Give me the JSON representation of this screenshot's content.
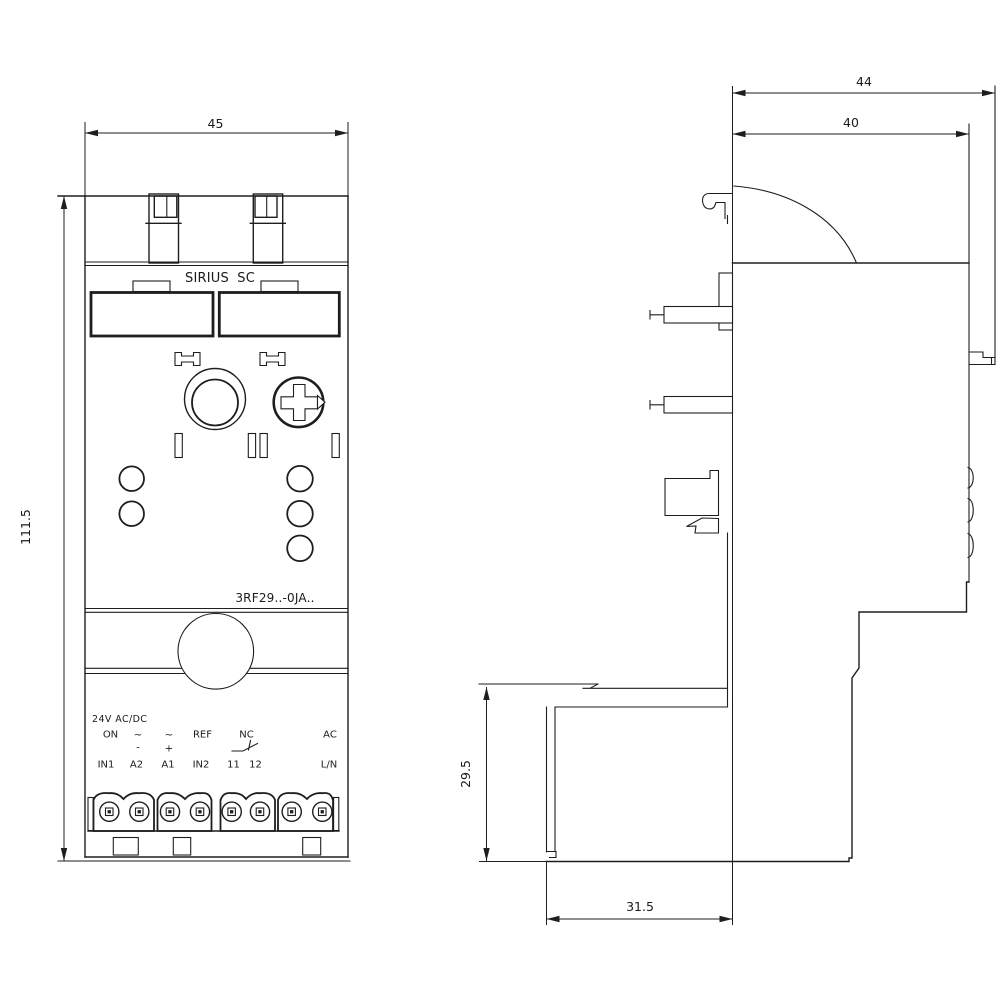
{
  "front_view": {
    "width_dim": "45",
    "height_dim": "111.5",
    "brand_label": "SIRIUS SC",
    "type_label": "3RF29..-0JA..",
    "labels": {
      "supply": "24V AC/DC",
      "on": "ON",
      "tilde_a2": "~",
      "minus_a2": "-",
      "tilde_a1": "~",
      "plus_a1": "+",
      "ref": "REF",
      "nc": "NC",
      "ac": "AC",
      "in1": "IN1",
      "a2": "A2",
      "a1": "A1",
      "in2": "IN2",
      "t11": "11",
      "t12": "12",
      "ln": "L/N"
    }
  },
  "side_view": {
    "overall_depth_dim": "44",
    "body_depth_dim": "40",
    "terminal_depth_dim": "31.5",
    "terminal_height_dim": "29.5"
  }
}
